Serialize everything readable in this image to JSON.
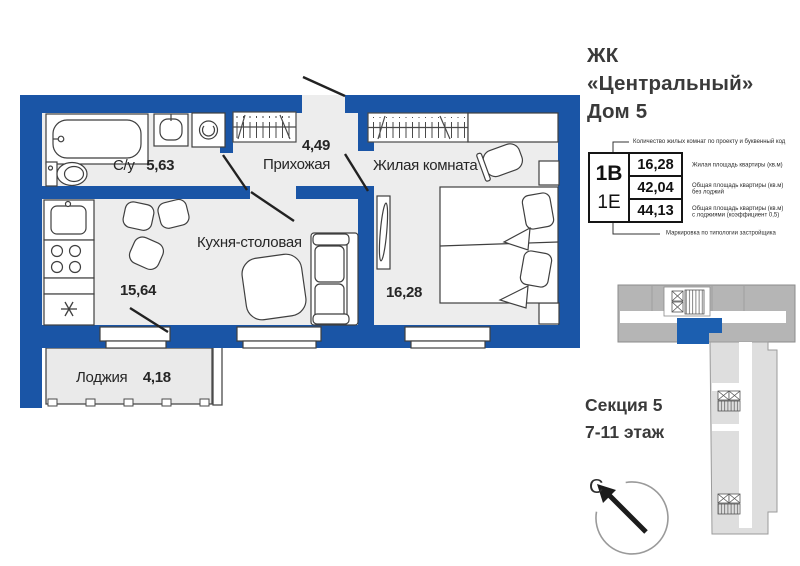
{
  "title": {
    "line1": "ЖК",
    "line2": "«Центральный»",
    "line3": "Дом 5"
  },
  "plan": {
    "rooms": [
      {
        "name": "С/у",
        "area": "5,63"
      },
      {
        "name": "Прихожая",
        "area": "4,49"
      },
      {
        "name": "Жилая комната",
        "area": "16,28"
      },
      {
        "name": "Кухня-столовая",
        "area": "15,64"
      },
      {
        "name": "Лоджия",
        "area": "4,18"
      }
    ]
  },
  "legend": {
    "top_note": "Количество жилых комнат по проекту и буквенный код",
    "bottom_note": "Маркировка по типологии застройщика",
    "code_primary": "1В",
    "code_secondary": "1Е",
    "rows": [
      {
        "value": "16,28",
        "label_line1": "Жилая площадь квартиры (кв.м)",
        "label_line2": ""
      },
      {
        "value": "42,04",
        "label_line1": "Общая площадь квартиры (кв.м)",
        "label_line2": "без лоджий"
      },
      {
        "value": "44,13",
        "label_line1": "Общая площадь квартиры (кв.м)",
        "label_line2": "с лоджиями (коэффициент 0,5)"
      }
    ]
  },
  "section_info": {
    "line1": "Секция 5",
    "line2": "7-11 этаж"
  },
  "compass": {
    "north_label": "С"
  },
  "colors": {
    "wall_blue": "#1a55a6",
    "highlight_unit_blue": "#1c5fb0",
    "floor_gray": "#ededed",
    "keyplan_dark_gray": "#b5b5b5",
    "keyplan_light_gray": "#dedede"
  }
}
